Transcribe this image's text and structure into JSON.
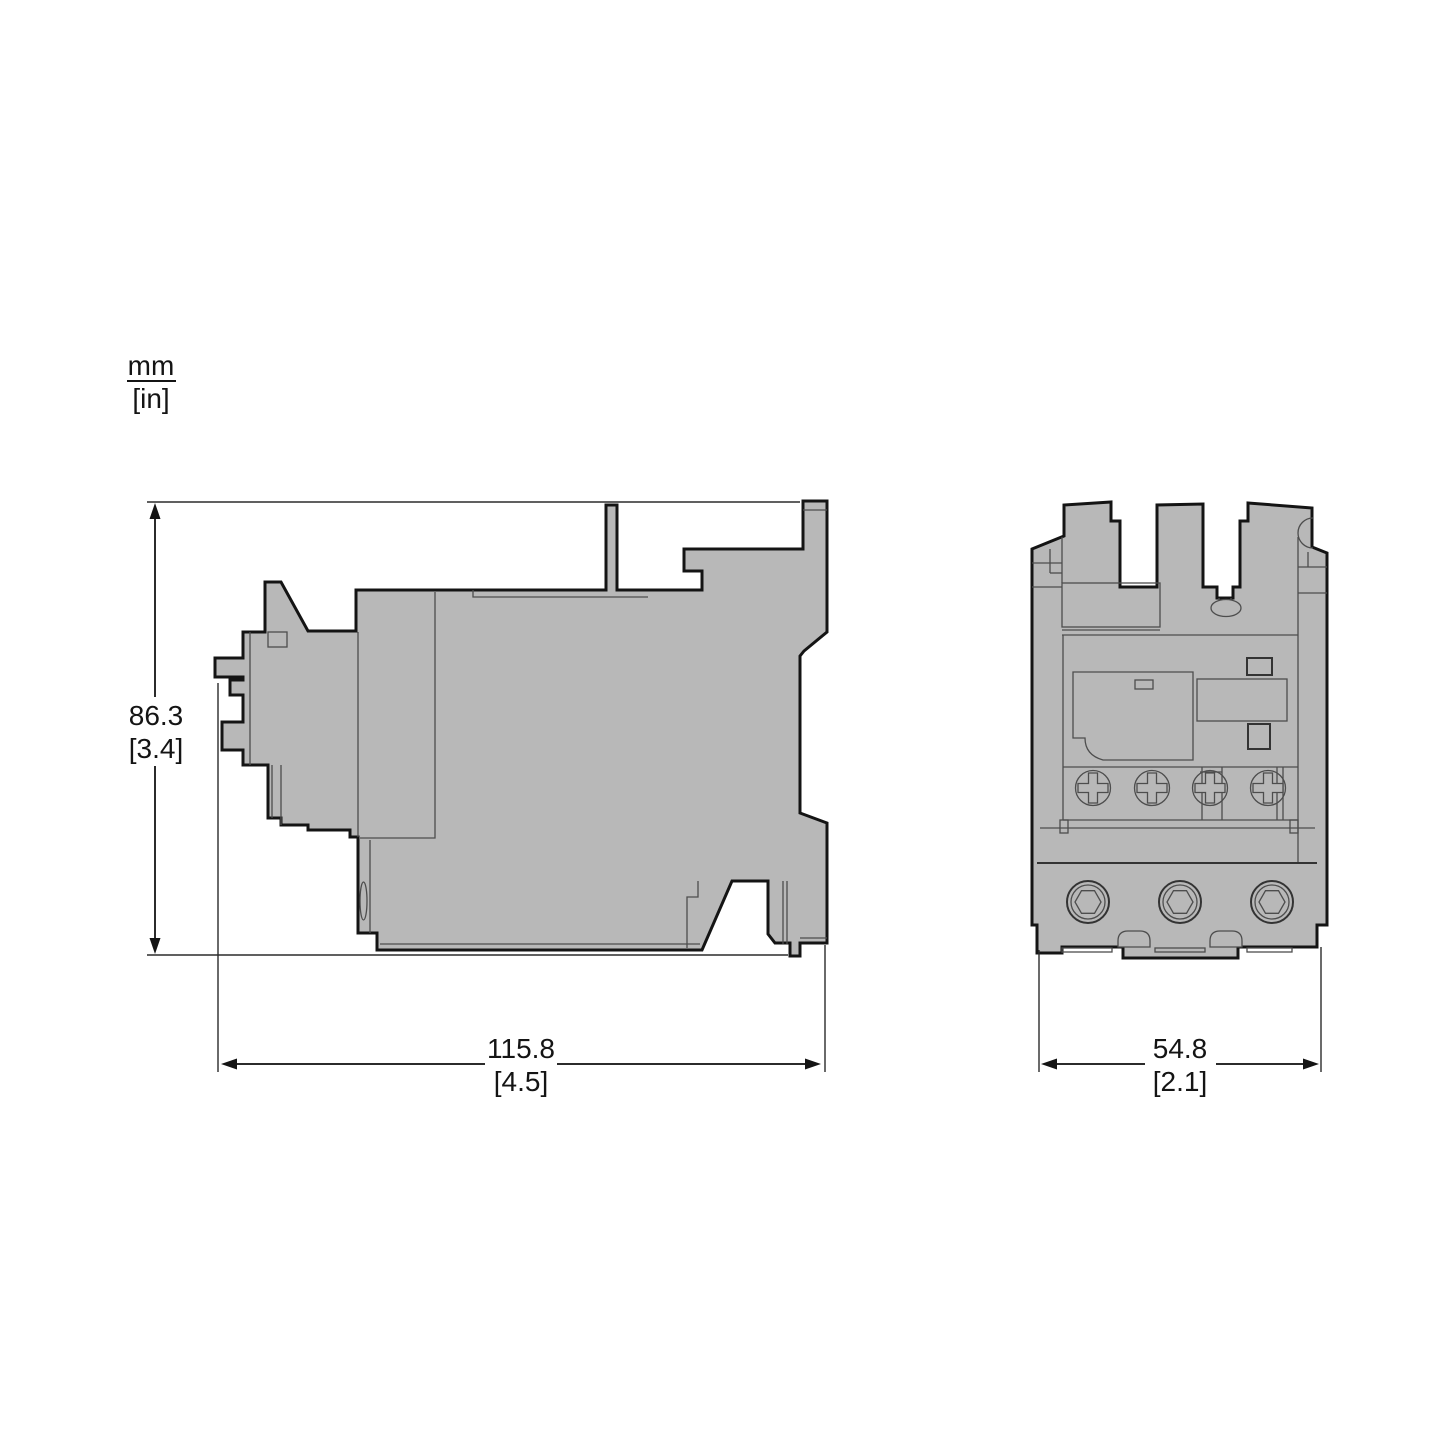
{
  "units": {
    "primary": "mm",
    "secondary": "[in]"
  },
  "dims": {
    "height": {
      "primary": "86.3",
      "secondary": "[3.4]"
    },
    "side_width": {
      "primary": "115.8",
      "secondary": "[4.5]"
    },
    "front_width": {
      "primary": "54.8",
      "secondary": "[2.1]"
    }
  },
  "colors": {
    "background": "#ffffff",
    "body_fill": "#b8b8b8",
    "outline": "#141414",
    "detail_lines": "#4d4d4d",
    "dimension_lines": "#2b2b2b"
  },
  "views": {
    "side": {
      "name": "side-view"
    },
    "front": {
      "name": "front-view"
    }
  }
}
